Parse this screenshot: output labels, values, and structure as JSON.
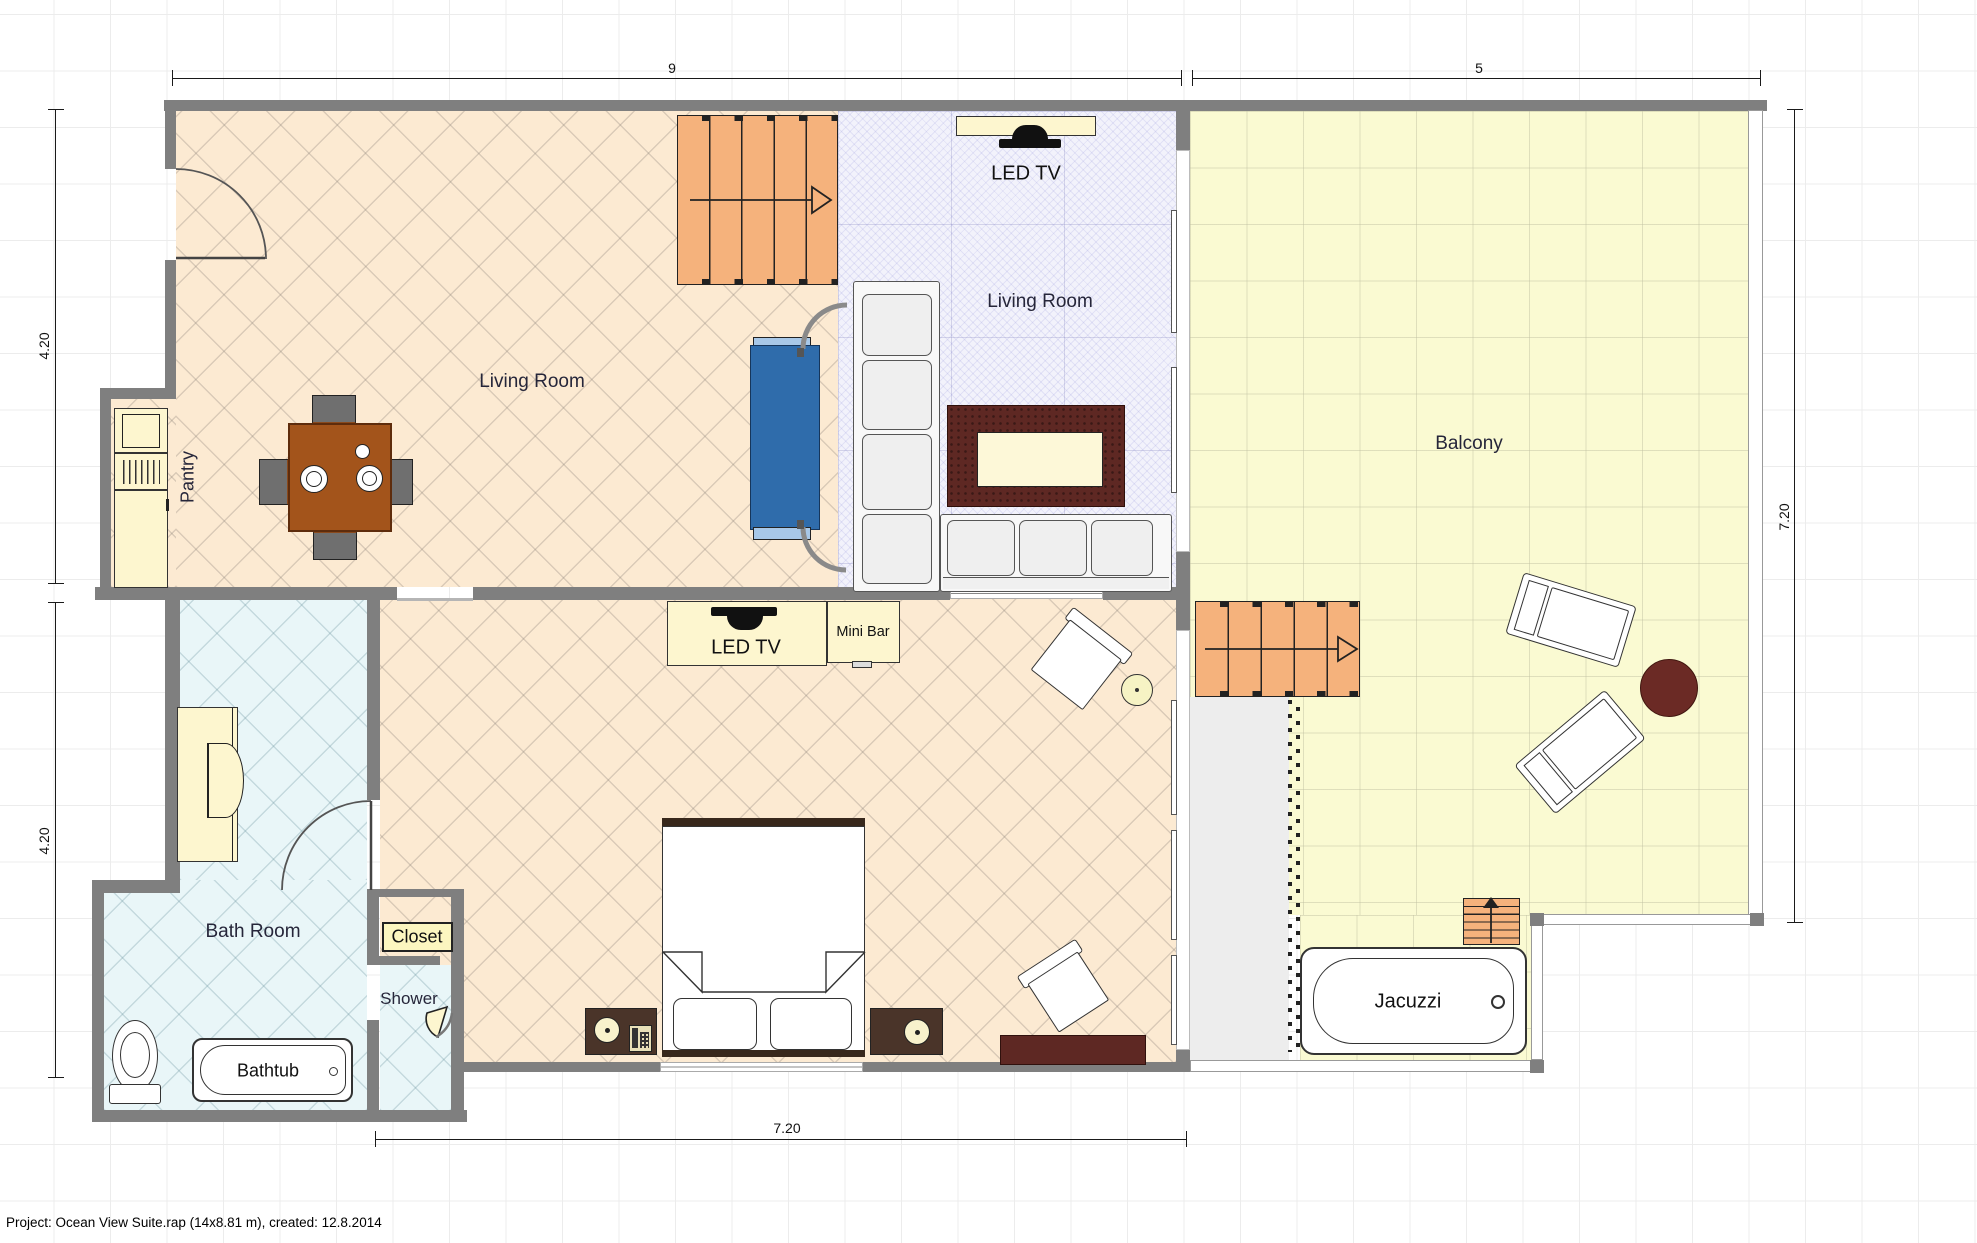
{
  "footer": {
    "text": "Project: Ocean View Suite.rap (14x8.81 m), created: 12.8.2014"
  },
  "rooms": {
    "living_room_main": "Living Room",
    "living_room_tv": "Living Room",
    "balcony": "Balcony",
    "bath_room": "Bath Room",
    "pantry": "Pantry",
    "shower": "Shower"
  },
  "objects": {
    "closet": "Closet",
    "bathtub": "Bathtub",
    "jacuzzi": "Jacuzzi",
    "mini_bar": "Mini Bar",
    "led_tv_living": "LED TV",
    "led_tv_bedroom": "LED TV"
  },
  "dimensions": {
    "width_main": "9",
    "width_balcony": "5",
    "height_upper_left": "4.20",
    "height_lower_left": "4.20",
    "height_right": "7.20",
    "width_bottom": "7.20"
  },
  "colors": {
    "wall": "#7f7f7f",
    "floor_living": "#fcead2",
    "floor_tv_area": "#f2f2fb",
    "floor_bath": "#e9f6f8",
    "floor_balcony": "#fafad2",
    "stairs": "#f5b27c",
    "door_blue": "#2f6cab",
    "table_wood": "#a3541b",
    "rug_dark": "#5e2823",
    "cabinet_cream": "#fdf6cf"
  }
}
